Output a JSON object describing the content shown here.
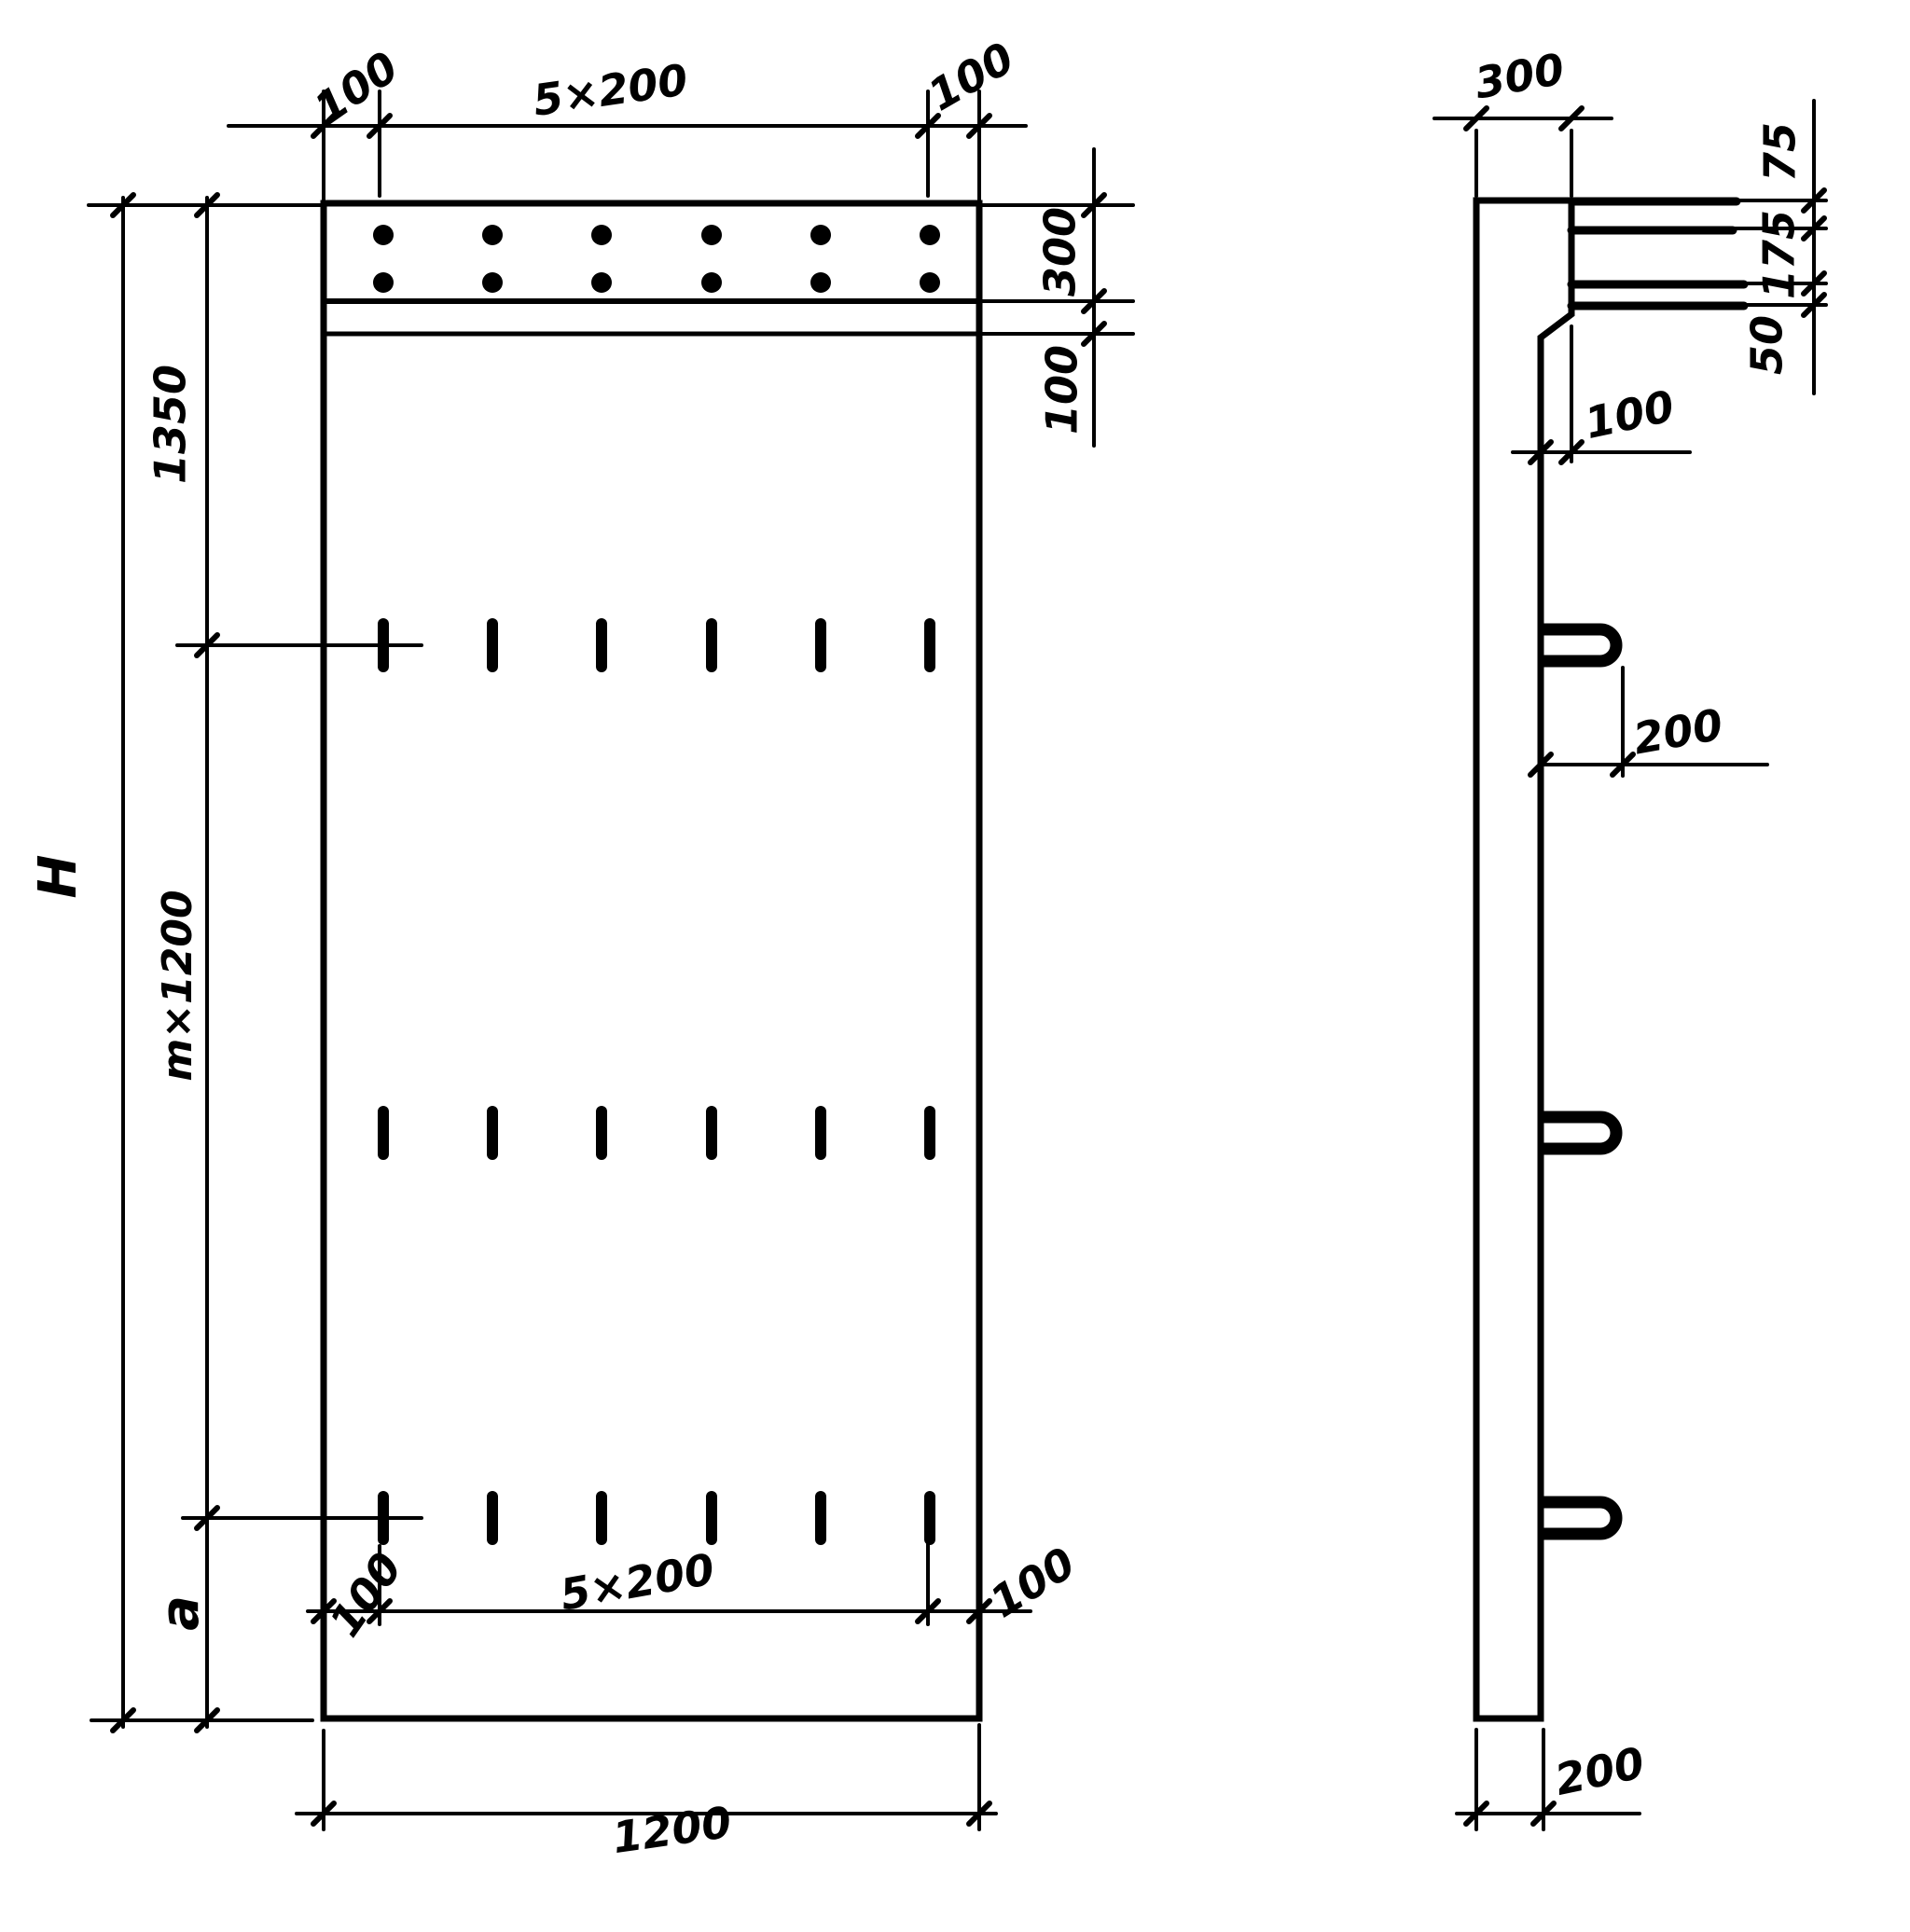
{
  "front_view": {
    "dim_top_left": "100",
    "dim_top_pitch": "5×200",
    "dim_top_right": "100",
    "dim_band_height": "300",
    "dim_band_gap": "100",
    "dim_left_top": "1350",
    "dim_left_middle": "m×1200",
    "dim_left_bottom": "a",
    "dim_total_height": "H",
    "dim_bottom_left": "100",
    "dim_bottom_pitch": "5×200",
    "dim_bottom_right": "100",
    "dim_overall_width": "1200"
  },
  "side_view": {
    "dim_width_top": "300",
    "dim_bar_top": "75",
    "dim_bar_middle": "175",
    "dim_bar_bottom": "50",
    "dim_chamfer": "100",
    "dim_loop_length": "200",
    "dim_thickness_bottom": "200"
  }
}
